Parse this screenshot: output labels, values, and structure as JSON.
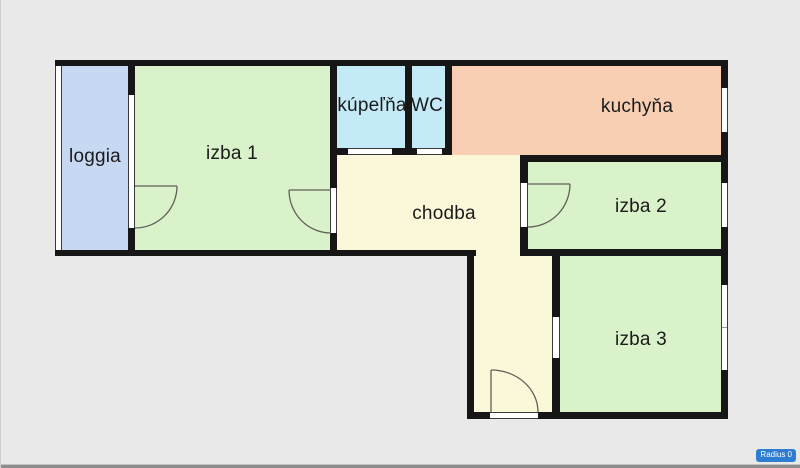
{
  "floorplan": {
    "background": "#e9e9e9",
    "wall_color": "#161616",
    "window_frame_color": "#3a3a3a",
    "door_swing_color": "#60605a",
    "label_color": "#1b1b1b",
    "rooms": [
      {
        "id": "loggia",
        "label": "loggia",
        "color": "#c7d8f3"
      },
      {
        "id": "izba-1",
        "label": "izba 1",
        "color": "#daf2c9"
      },
      {
        "id": "kupelna",
        "label": "kúpeľňa",
        "color": "#c4eaf8"
      },
      {
        "id": "wc",
        "label": "WC",
        "color": "#c4eaf8"
      },
      {
        "id": "kuchyna",
        "label": "kuchyňa",
        "color": "#f8cfb3"
      },
      {
        "id": "chodba",
        "label": "chodba",
        "color": "#fbf7d9"
      },
      {
        "id": "izba-2",
        "label": "izba 2",
        "color": "#daf2c9"
      },
      {
        "id": "izba-3",
        "label": "izba 3",
        "color": "#daf2c9"
      }
    ]
  },
  "badge": {
    "label": "Radius 0",
    "color": "#2e7dd1"
  }
}
